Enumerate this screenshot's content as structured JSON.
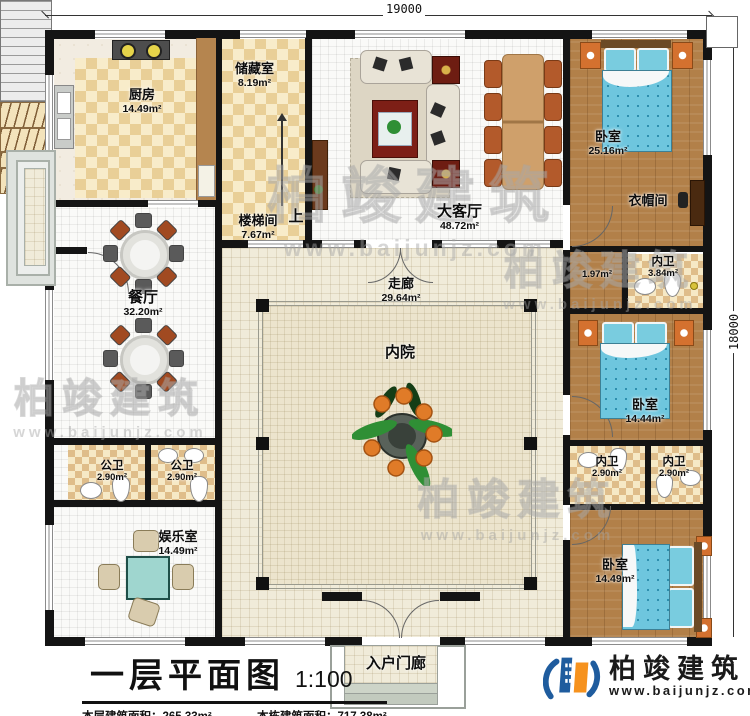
{
  "dimensions": {
    "top": "19000",
    "right": "18000"
  },
  "rooms": {
    "kitchen": {
      "name": "厨房",
      "area": "14.49m²"
    },
    "storage": {
      "name": "储藏室",
      "area": "8.19m²"
    },
    "stairwell": {
      "name": "楼梯间",
      "area": "7.67m²",
      "direction": "上"
    },
    "living": {
      "name": "大客厅",
      "area": "48.72m²"
    },
    "bedroom_top": {
      "name": "卧室",
      "area": "25.16m²"
    },
    "cloakroom": {
      "name": "衣帽间"
    },
    "nook": {
      "area": "1.97m²"
    },
    "bath_top": {
      "name": "内卫",
      "area": "3.84m²"
    },
    "bedroom_mid": {
      "name": "卧室",
      "area": "14.44m²"
    },
    "bath_mid_left": {
      "name": "内卫",
      "area": "2.90m²"
    },
    "bath_mid_right": {
      "name": "内卫",
      "area": "2.90m²"
    },
    "bedroom_bottom": {
      "name": "卧室",
      "area": "14.49m²"
    },
    "dining": {
      "name": "餐厅",
      "area": "32.20m²"
    },
    "public_bath_1": {
      "name": "公卫",
      "area": "2.90m²"
    },
    "public_bath_2": {
      "name": "公卫",
      "area": "2.90m²"
    },
    "recreation": {
      "name": "娱乐室",
      "area": "14.49m²"
    },
    "corridor": {
      "name": "走廊",
      "area": "29.64m²"
    },
    "courtyard": {
      "name": "内院"
    },
    "porch": {
      "name": "入户门廊"
    }
  },
  "footer": {
    "title": "一层平面图",
    "scale": "1:100",
    "stats": [
      {
        "label": "本层建筑面积：",
        "value": "265.33m²"
      },
      {
        "label": "本栋建筑面积：",
        "value": "717.38m²"
      },
      {
        "label": "占地面积：",
        "value": "350.94m²"
      },
      {
        "label": "层高：",
        "value": "4.2m"
      }
    ]
  },
  "brand": {
    "name": "柏竣建筑",
    "url": "www.baijunjz.com"
  },
  "watermark": {
    "text": "柏竣建筑",
    "url": "www.baijunjz.com"
  },
  "colors": {
    "wall": "#141414",
    "wood_floor": "#b28049",
    "checker_tan": "#e9cf97",
    "bed_blue": "#6ec6de",
    "logo_blue": "#1f5c9e",
    "logo_orange": "#f6921e"
  }
}
